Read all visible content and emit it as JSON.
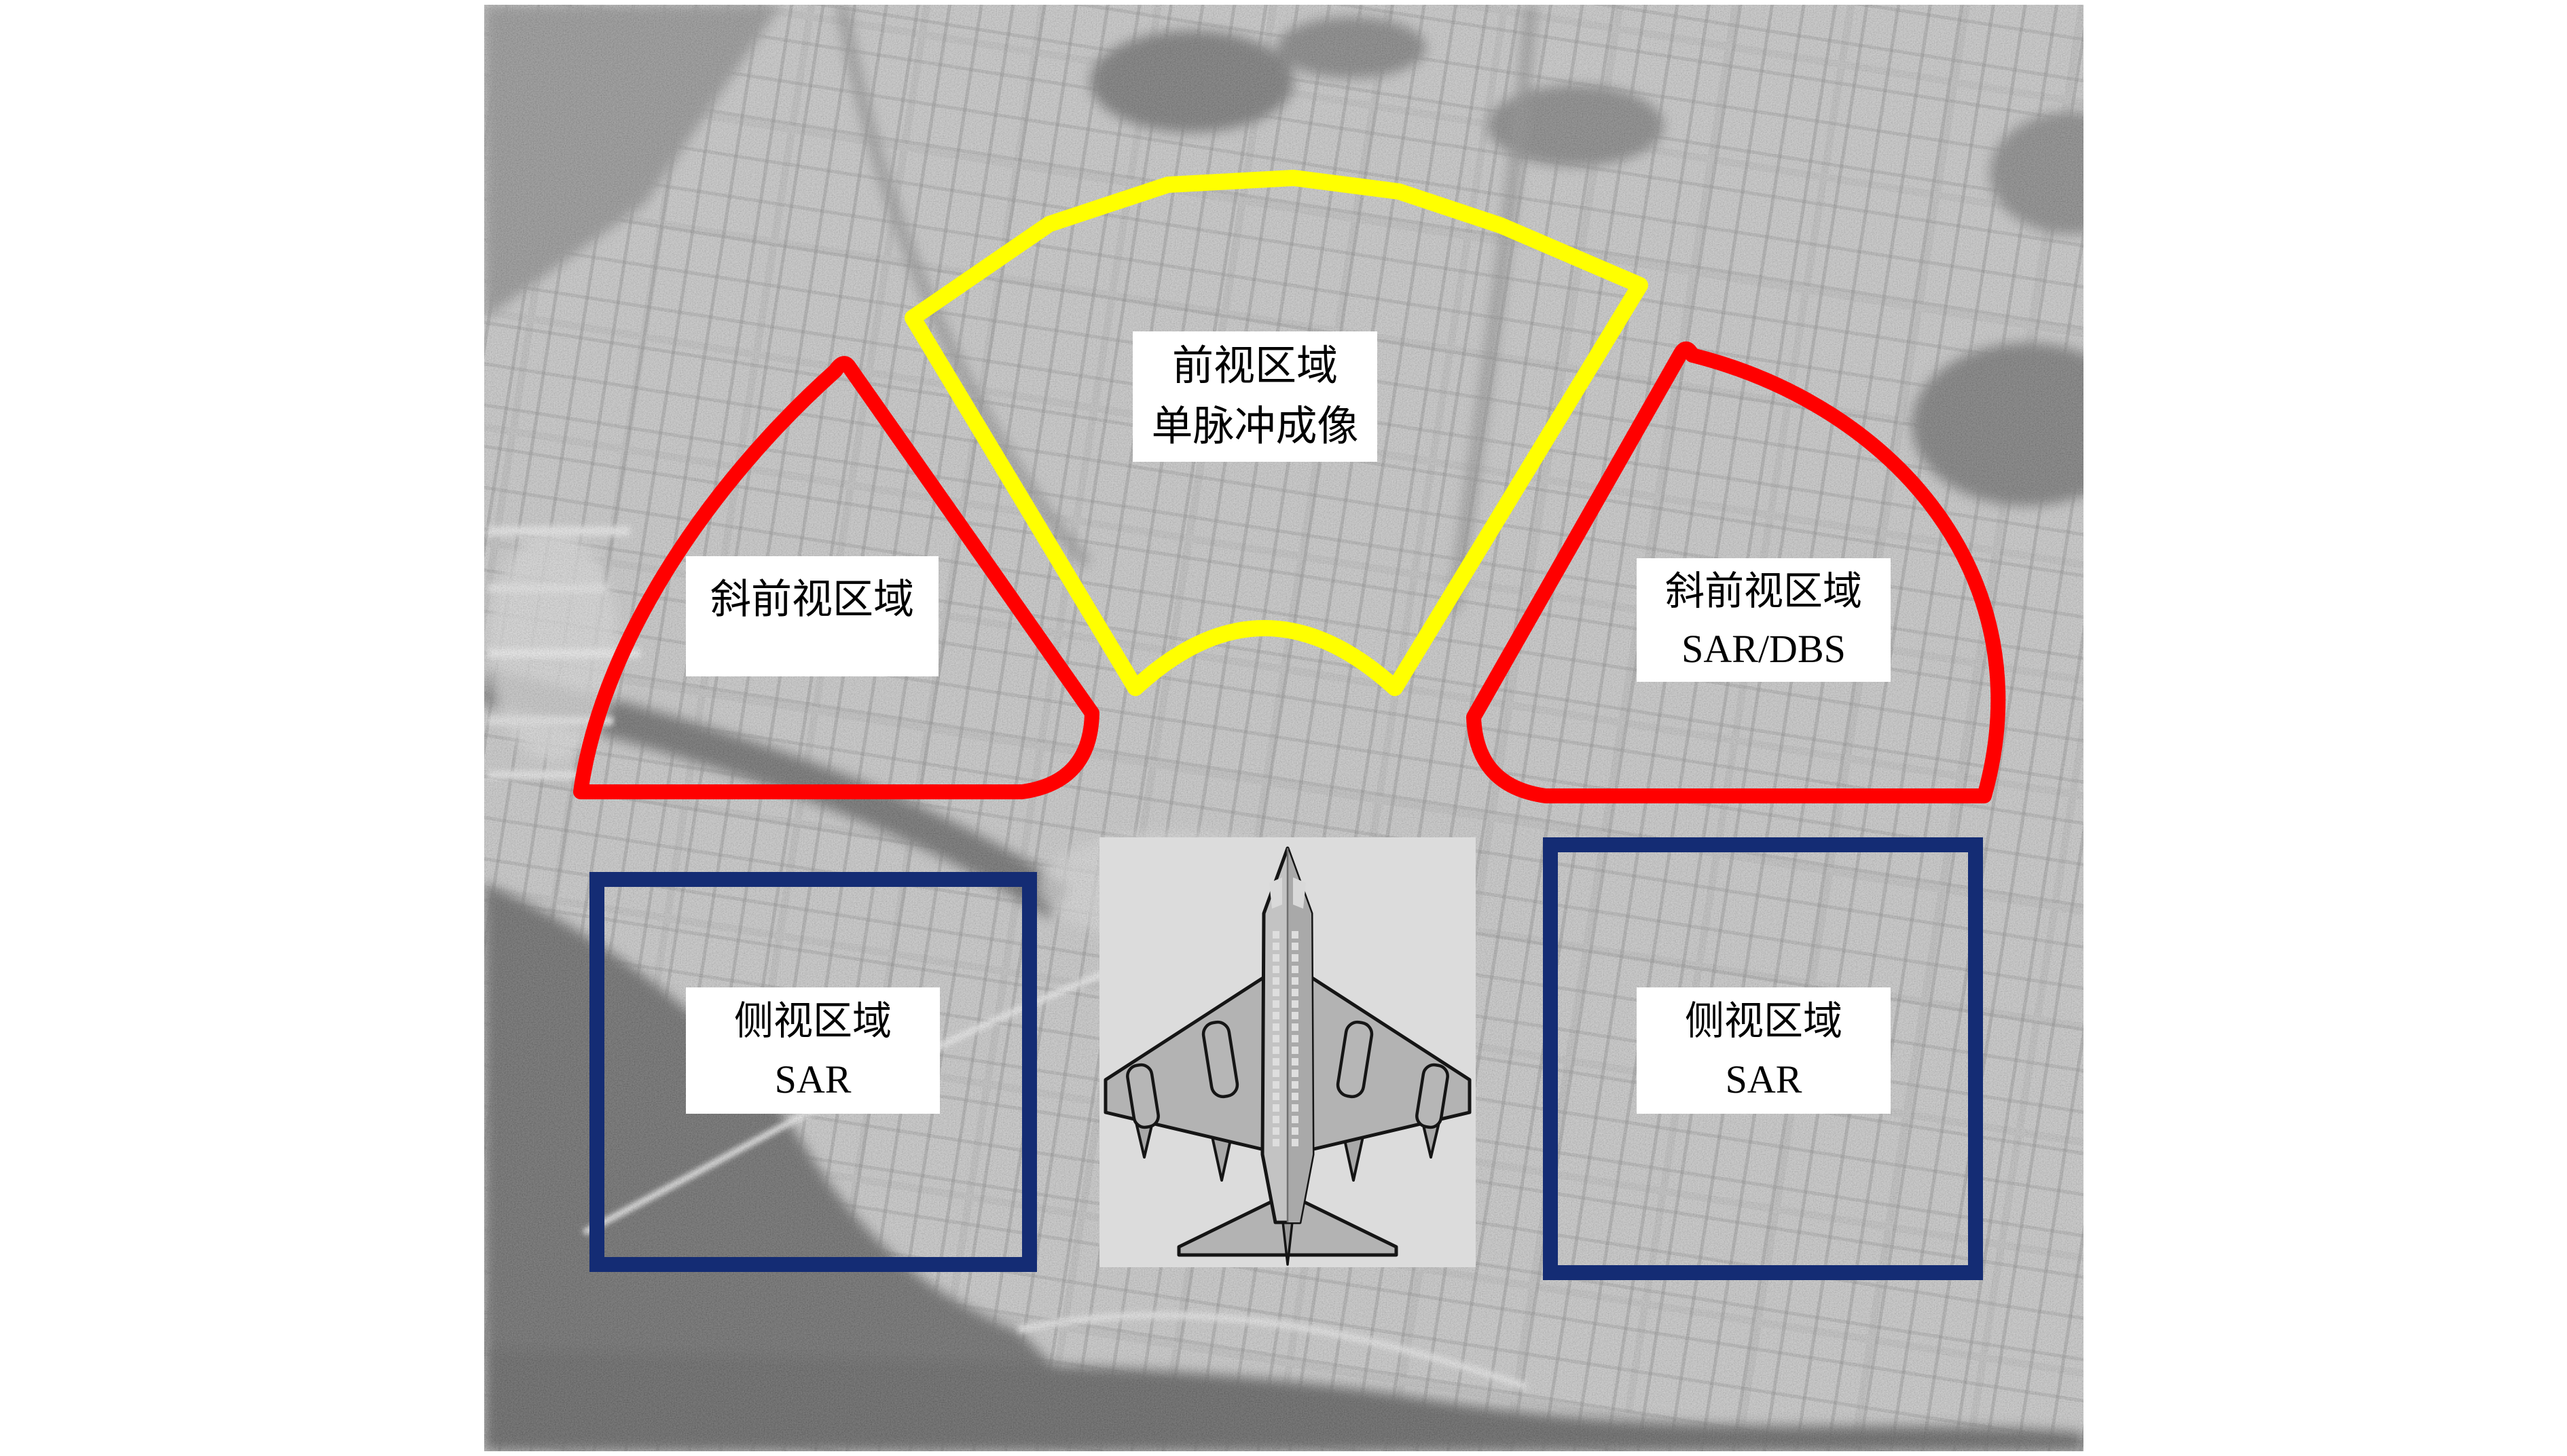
{
  "figure": {
    "colors": {
      "page_bg": "#ffffff",
      "forward": "#ffff00",
      "squint": "#ff0000",
      "side": "#142c74",
      "label_bg": "#ffffff",
      "label_text": "#000000",
      "plane_box": "#dcdcdc"
    },
    "labels": {
      "forward": {
        "line1": "前视区域",
        "line2": "单脉冲成像"
      },
      "squint_left": {
        "line1": "斜前视区域"
      },
      "squint_right": {
        "line1": "斜前视区域",
        "line2": "SAR/DBS"
      },
      "side_left": {
        "line1": "侧视区域",
        "line2": "SAR"
      },
      "side_right": {
        "line1": "侧视区域",
        "line2": "SAR"
      }
    },
    "icons": {
      "aircraft": "airplane-top-view-icon"
    },
    "background_description": "SAR grayscale aerial city image"
  }
}
